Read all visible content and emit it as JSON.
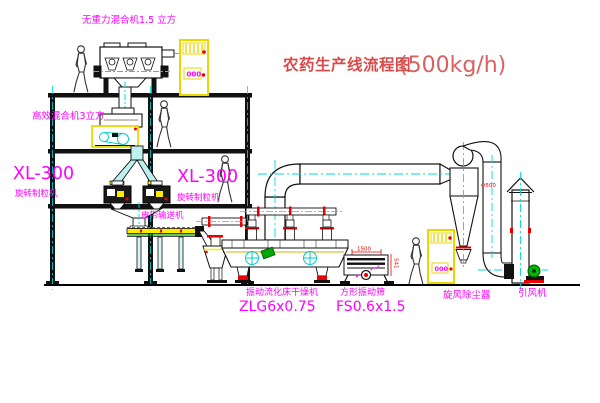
{
  "title": {
    "main": "农药生产线流程图",
    "capacity": "(500kg/h)"
  },
  "labels": {
    "top_mixer": "无重力混合机1.5 立方",
    "mixer2": "高效混合机3立方",
    "granulator_left_model": "XL-300",
    "granulator_left_name": "旋转制粒机",
    "granulator_right_model": "XL-300",
    "granulator_right_name": "旋转制粒机",
    "belt_conveyor": "皮带输送机",
    "dryer_name": "振动流化床干燥机",
    "dryer_model": "ZLG6x0.75",
    "screen_name": "方形振动筛",
    "screen_model": "FS0.6x1.5",
    "cyclone": "旋风除尘器",
    "fan": "引风机"
  },
  "dimensions": {
    "screen_length": "1500",
    "screen_height": "541",
    "duct_diameter": "Φ500"
  },
  "cabinet_display": "000",
  "colors": {
    "background": "#ffffff",
    "line": "#111111",
    "centerline_cyan": "#00dada",
    "highlight_yellow": "#e8d800",
    "label_magenta": "#ff00ff",
    "title_red": "#d94b4b",
    "accent_red": "#e80000",
    "accent_green": "#00a800",
    "pipe_fill": "#bff0f0"
  }
}
